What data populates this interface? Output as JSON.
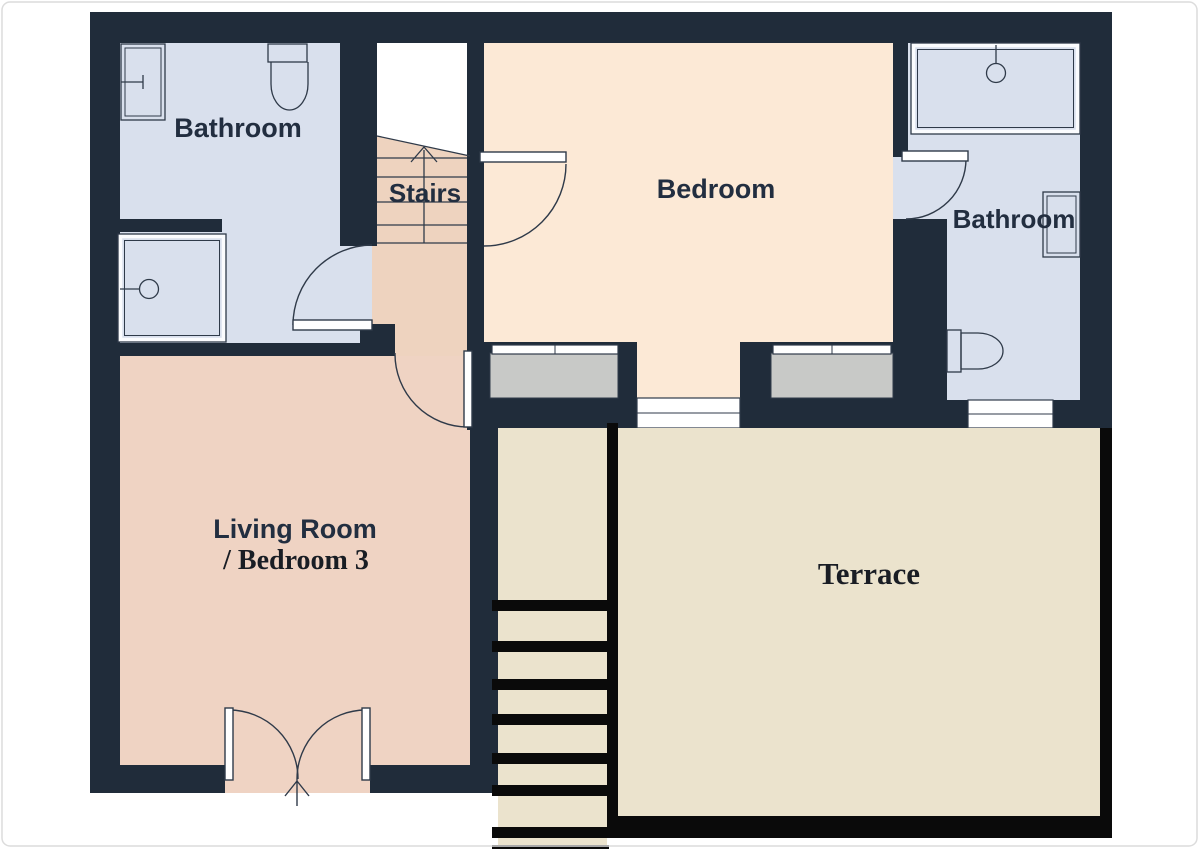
{
  "plan": {
    "rooms": {
      "bathroom1": {
        "label": "Bathroom"
      },
      "stairs": {
        "label": "Stairs"
      },
      "bedroom": {
        "label": "Bedroom"
      },
      "bathroom2": {
        "label": "Bathroom"
      },
      "living": {
        "line1": "Living Room",
        "line2": "/ Bedroom 3"
      },
      "terrace": {
        "label": "Terrace"
      }
    },
    "fixtures": {
      "bathroom1": [
        "sink",
        "toilet",
        "shower"
      ],
      "bathroom2": [
        "shower-tray",
        "sink",
        "toilet"
      ]
    },
    "annotations": {
      "stairs_direction": "up",
      "entrance_direction": "in"
    },
    "colors": {
      "wall": "#202c3a",
      "outdoor": "#0a0a0a",
      "bathroom_floor": "#d9e0ed",
      "bedroom_floor": "#fce9d6",
      "stairs_floor": "#eed3bf",
      "living_floor": "#efd3c3",
      "terrace_floor": "#ebe3cd",
      "window_sill": "#c8c9c7",
      "landing": "#ffffff",
      "line": "#2f3a49",
      "label_sans": "#222e40",
      "label_serif": "#191d24",
      "canvas_border": "#dcdcdc",
      "canvas_bg": "#ffffff"
    }
  }
}
